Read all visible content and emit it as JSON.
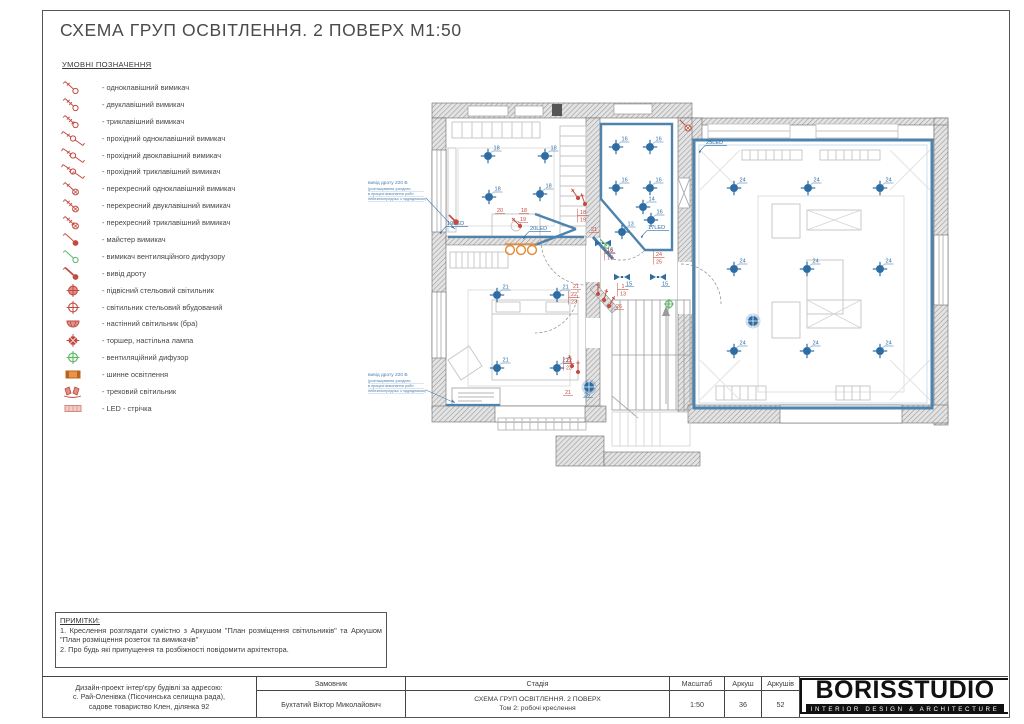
{
  "page": {
    "title": "СХЕМА ГРУП ОСВІТЛЕННЯ. 2 ПОВЕРХ М1:50",
    "legend": {
      "heading": "УМОВНІ ПОЗНАЧЕННЯ",
      "items": [
        {
          "icon": "switch-1-icon",
          "label": "- одноклавішний вимикач"
        },
        {
          "icon": "switch-2-icon",
          "label": "- двуклавішний вимикач"
        },
        {
          "icon": "switch-3-icon",
          "label": "- триклавішний вимикач"
        },
        {
          "icon": "pass-switch-1-icon",
          "label": "- прохідний одноклавішний вимикач"
        },
        {
          "icon": "pass-switch-2-icon",
          "label": "- прохідний двоклавішний вимикач"
        },
        {
          "icon": "pass-switch-3-icon",
          "label": "- прохідний триклавішний вимикач"
        },
        {
          "icon": "cross-switch-1-icon",
          "label": "- перехресний одноклавішний вимикач"
        },
        {
          "icon": "cross-switch-2-icon",
          "label": "- перехресний двуклавішний вимикач"
        },
        {
          "icon": "cross-switch-3-icon",
          "label": "- перехресний триклавішний вимикач"
        },
        {
          "icon": "master-switch-icon",
          "label": "- майстер вимикач"
        },
        {
          "icon": "vent-switch-icon",
          "label": "- вимикач вентиляційного дифузору"
        },
        {
          "icon": "wire-outlet-icon",
          "label": "- вивід дроту"
        },
        {
          "icon": "pendant-light-icon",
          "label": "- підвісний стельовий світильник"
        },
        {
          "icon": "recessed-light-icon",
          "label": "- світильник стельовий вбудований"
        },
        {
          "icon": "wall-light-icon",
          "label": "- настінний світильник (бра)"
        },
        {
          "icon": "floor-lamp-icon",
          "label": "- торшер, настільна лампа"
        },
        {
          "icon": "vent-diffuser-icon",
          "label": "- вентиляційний дифузор"
        },
        {
          "icon": "bus-light-icon",
          "label": "- шинне освітлення"
        },
        {
          "icon": "track-light-icon",
          "label": "- трековий світильник"
        },
        {
          "icon": "led-strip-icon",
          "label": "- LED - стрічка"
        }
      ]
    },
    "plan": {
      "lights": [
        {
          "x": 488,
          "y": 156,
          "label": "18"
        },
        {
          "x": 545,
          "y": 156,
          "label": "18"
        },
        {
          "x": 489,
          "y": 197,
          "label": "18"
        },
        {
          "x": 540,
          "y": 194,
          "label": "18"
        },
        {
          "x": 616,
          "y": 147,
          "label": "16"
        },
        {
          "x": 650,
          "y": 147,
          "label": "16"
        },
        {
          "x": 616,
          "y": 188,
          "label": "16"
        },
        {
          "x": 650,
          "y": 188,
          "label": "16"
        },
        {
          "x": 651,
          "y": 220,
          "label": "16"
        },
        {
          "x": 643,
          "y": 207,
          "label": "14"
        },
        {
          "x": 622,
          "y": 232,
          "label": "13"
        },
        {
          "x": 497,
          "y": 295,
          "label": "21"
        },
        {
          "x": 557,
          "y": 295,
          "label": "21"
        },
        {
          "x": 497,
          "y": 368,
          "label": "21"
        },
        {
          "x": 557,
          "y": 368,
          "label": "21"
        },
        {
          "x": 734,
          "y": 188,
          "label": "24"
        },
        {
          "x": 808,
          "y": 188,
          "label": "24"
        },
        {
          "x": 880,
          "y": 188,
          "label": "24"
        },
        {
          "x": 734,
          "y": 269,
          "label": "24"
        },
        {
          "x": 807,
          "y": 269,
          "label": "24"
        },
        {
          "x": 880,
          "y": 269,
          "label": "24"
        },
        {
          "x": 734,
          "y": 351,
          "label": "24"
        },
        {
          "x": 807,
          "y": 351,
          "label": "24"
        },
        {
          "x": 880,
          "y": 351,
          "label": "24"
        }
      ],
      "pendants": [
        {
          "x": 753,
          "y": 321,
          "label": ""
        },
        {
          "x": 589,
          "y": 387,
          "label": "25"
        }
      ],
      "tracks": [
        {
          "x": 603,
          "y": 243,
          "label": "15"
        },
        {
          "x": 622,
          "y": 277,
          "label": "15"
        },
        {
          "x": 658,
          "y": 277,
          "label": "15"
        }
      ],
      "led_labels": [
        {
          "x": 447,
          "y": 225,
          "text": "19LED"
        },
        {
          "x": 530,
          "y": 230,
          "text": "20LED"
        },
        {
          "x": 648,
          "y": 229,
          "text": "17LED"
        },
        {
          "x": 706,
          "y": 144,
          "text": "25LED"
        }
      ],
      "red_labels": [
        {
          "x": 500,
          "y": 212,
          "text": "20"
        },
        {
          "x": 524,
          "y": 212,
          "text": "18"
        },
        {
          "x": 523,
          "y": 221,
          "text": "19"
        },
        {
          "x": 594,
          "y": 231,
          "text": "21"
        },
        {
          "x": 576,
          "y": 288,
          "text": "21"
        },
        {
          "x": 568,
          "y": 394,
          "text": "21"
        },
        {
          "x": 619,
          "y": 308,
          "text": "26"
        }
      ],
      "red_stacks": [
        {
          "x": 583,
          "y": 215,
          "top": "18",
          "bottom": "19"
        },
        {
          "x": 610,
          "y": 253,
          "top": "16",
          "bottom": "17"
        },
        {
          "x": 659,
          "y": 257,
          "top": "24",
          "bottom": "25"
        },
        {
          "x": 623,
          "y": 289,
          "top": "1",
          "bottom": "13"
        },
        {
          "x": 574,
          "y": 297,
          "top": "22",
          "bottom": "23"
        },
        {
          "x": 569,
          "y": 363,
          "top": "22",
          "bottom": "23"
        }
      ],
      "switch_marks": [
        {
          "x": 520,
          "y": 226,
          "type": "sw",
          "rot": 0
        },
        {
          "x": 578,
          "y": 198,
          "type": "sw",
          "rot": 10
        },
        {
          "x": 585,
          "y": 204,
          "type": "sw",
          "rot": 25
        },
        {
          "x": 598,
          "y": 294,
          "type": "sw",
          "rot": 45
        },
        {
          "x": 604,
          "y": 300,
          "type": "sw",
          "rot": 60
        },
        {
          "x": 609,
          "y": 306,
          "type": "sw",
          "rot": 75
        },
        {
          "x": 572,
          "y": 366,
          "type": "sw",
          "rot": 30
        },
        {
          "x": 578,
          "y": 372,
          "type": "sw",
          "rot": 45
        },
        {
          "x": 456,
          "y": 222,
          "type": "outlet",
          "rot": 0
        },
        {
          "x": 688,
          "y": 128,
          "type": "cross",
          "rot": 0
        },
        {
          "x": 607,
          "y": 246,
          "type": "vent-sw",
          "rot": 0
        },
        {
          "x": 669,
          "y": 304,
          "type": "vent",
          "rot": 0
        },
        {
          "x": 510,
          "y": 250,
          "type": "bus",
          "rot": 0
        }
      ],
      "annotations": [
        {
          "x": 368,
          "y": 184,
          "tx": 455,
          "ty": 229,
          "lines": [
            "вивід дроту 220 В",
            "(розташування узгодити",
            "в процесі виконання робіт",
            "небезпосередньо з підрядником)"
          ]
        },
        {
          "x": 368,
          "y": 376,
          "tx": 455,
          "ty": 403,
          "lines": [
            "вивід дроту 220 В",
            "(розташування узгодити",
            "в процесі виконання робіт",
            "небезпосередньо з підрядником)"
          ]
        }
      ]
    },
    "notes": {
      "heading": "ПРИМІТКИ:",
      "lines": [
        "1. Креслення розглядати сумістно з Аркушом \"План розміщення світильників\" та Аркушом \"План розміщення розеток та вимикачів\"",
        "2. Про будь які припущення та розбіжності повідомити архітектора."
      ]
    },
    "titleblock": {
      "project_lines": [
        "Дизайн-проект інтер'єру будівлі за адресою:",
        "с. Рай-Оленівка (Пісочинська селищна рада),",
        "садове товариство Клен, ділянка 92"
      ],
      "customer_label": "Замовник",
      "customer_name": "Бухтатий Віктор Миколайович",
      "stage_label": "Стадія",
      "stage_line1": "СХЕМА ГРУП ОСВІТЛЕННЯ. 2 ПОВЕРХ",
      "stage_line2": "Том 2: робочі креслення",
      "scale_label": "Масштаб",
      "scale_value": "1:50",
      "sheet_label": "Аркуш",
      "sheet_value": "36",
      "sheets_label": "Аркушів",
      "sheets_value": "52",
      "logo_text": "BORISSTUDIO",
      "logo_tagline": "INTERIOR DESIGN & ARCHITECTURE"
    },
    "colors": {
      "accent_red": "#c34a3e",
      "accent_blue": "#2e6da4",
      "wall_blue": "#4e83ad",
      "accent_green": "#58b667",
      "accent_orange": "#e8872a",
      "led_pink": "#f5c9c4"
    }
  }
}
